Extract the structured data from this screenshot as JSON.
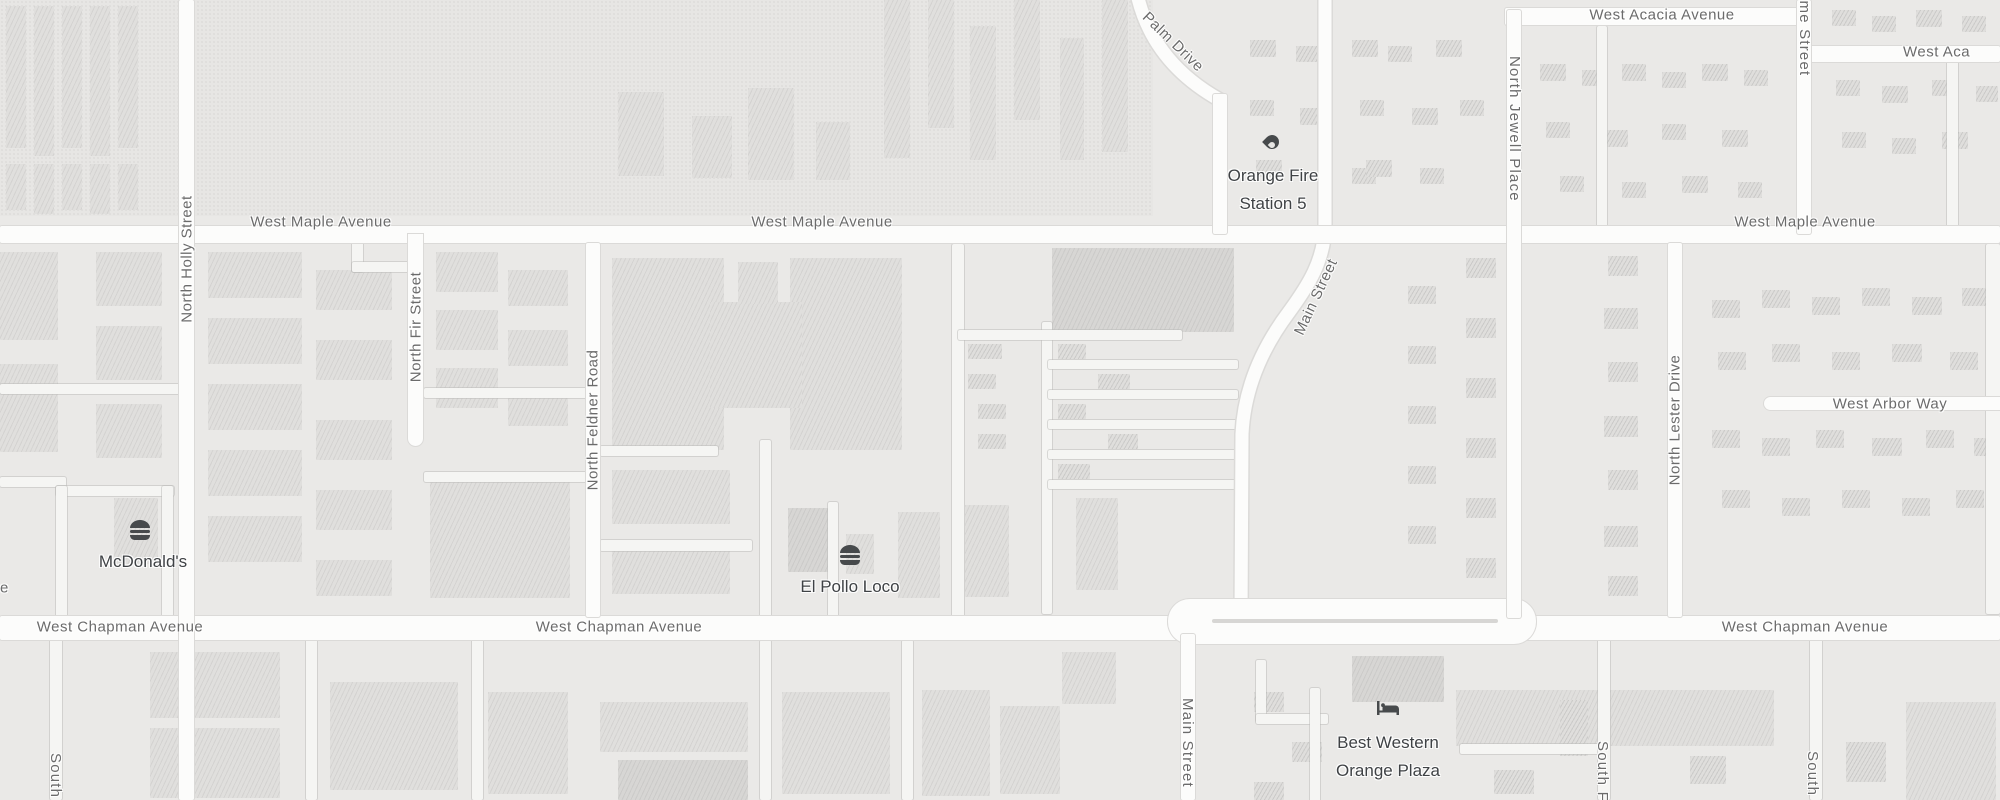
{
  "map_type": "grayscale-road-map",
  "streets": {
    "west_acacia_avenue": "West Acacia Avenue",
    "west_acacia_clipped": "West Aca",
    "lime_street_clipped": "ime Street",
    "north_jewell_place": "North Jewell Place",
    "palm_drive": "Palm Drive",
    "main_street": "Main Street",
    "west_maple_avenue": "West Maple Avenue",
    "north_holly_street": "North Holly Street",
    "north_fir_street": "North Fir Street",
    "north_feldner_road": "North Feldner Road",
    "north_lester_drive": "North Lester Drive",
    "west_arbor_way": "West Arbor Way",
    "west_chapman_avenue": "West Chapman Avenue",
    "south_clipped": "South",
    "south_f_clipped": "South F",
    "label_fragment_left_edge": "e"
  },
  "pois": [
    {
      "name": "Orange Fire Station 5",
      "line1": "Orange Fire",
      "line2": "Station 5",
      "icon": "fire-icon"
    },
    {
      "name": "McDonald's",
      "line1": "McDonald's",
      "icon": "burger-icon"
    },
    {
      "name": "El Pollo Loco",
      "line1": "El Pollo Loco",
      "icon": "burger-icon"
    },
    {
      "name": "Best Western Orange Plaza",
      "line1": "Best Western",
      "line2": "Orange Plaza",
      "icon": "bed-icon"
    }
  ],
  "colors": {
    "background": "#eae9e7",
    "campus_block": "#e7e6e4",
    "road_fill": "#fcfcfb",
    "road_casing": "#dbdad8",
    "building": "#e0dfdd",
    "building_dark": "#d7d6d4",
    "street_label": "#6b6b6b",
    "poi_label": "#3f4245",
    "poi_icon": "#474a4c"
  }
}
